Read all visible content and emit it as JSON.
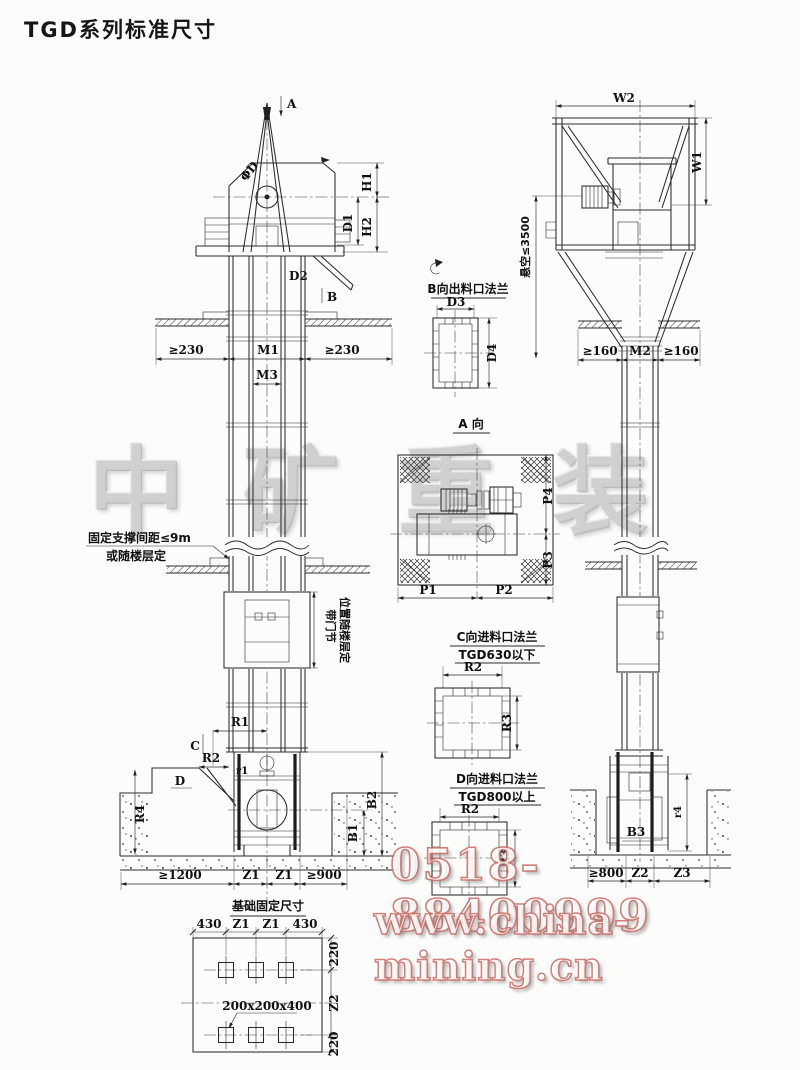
{
  "page": {
    "title": "TGD系列标准尺寸"
  },
  "watermarks": {
    "brand": [
      "中",
      "矿",
      "重",
      "装"
    ],
    "phone": "0518-88400999",
    "website": "www.china-mining.cn",
    "outline_color": "#c96a62"
  },
  "front_view": {
    "arrow_a": "A",
    "arrow_b": "B",
    "arrow_c": "C",
    "arrow_d": "D",
    "pulley_dia": "ΦD",
    "h1": "H1",
    "h2": "H2",
    "d1": "D1",
    "d2": "D2",
    "clear_left": "≥230",
    "m1": "M1",
    "m3": "M3",
    "clear_right": "≥230",
    "support_note1": "固定支撑间距≤9m",
    "support_note2": "或随楼层定",
    "door_note1": "带门节",
    "door_note2": "位置随楼层定",
    "r1": "R1",
    "r2": "R2",
    "r1_small": "r1",
    "r4": "R4",
    "b1": "B1",
    "b2": "B2",
    "base_left": "≥1200",
    "z1": "Z1",
    "base_right": "≥900"
  },
  "side_view": {
    "w1": "W1",
    "w2": "W2",
    "suspend": "悬空≤3500",
    "clear_left": "≥160",
    "m2": "M2",
    "clear_right": "≥160",
    "b3": "B3",
    "r4": "r4",
    "base_left": "≥800",
    "z2": "Z2",
    "z3": "Z3"
  },
  "details": {
    "flange_b": {
      "title": "B向出料口法兰",
      "d3": "D3",
      "d4": "D4"
    },
    "view_a": {
      "title": "A 向",
      "p1": "P1",
      "p2": "P2",
      "p3": "P3",
      "p4": "P4"
    },
    "flange_c": {
      "title": "C向进料口法兰",
      "subtitle": "TGD630以下",
      "r2": "R2",
      "r3": "R3"
    },
    "flange_d": {
      "title": "D向进料口法兰",
      "subtitle": "TGD800以上",
      "r2": "R2",
      "r3": "R3"
    }
  },
  "foundation": {
    "title": "基础固定尺寸",
    "dim_430": "430",
    "z1": "Z1",
    "dim_220": "220",
    "z2": "Z2",
    "hole_note": "200x200x400"
  }
}
